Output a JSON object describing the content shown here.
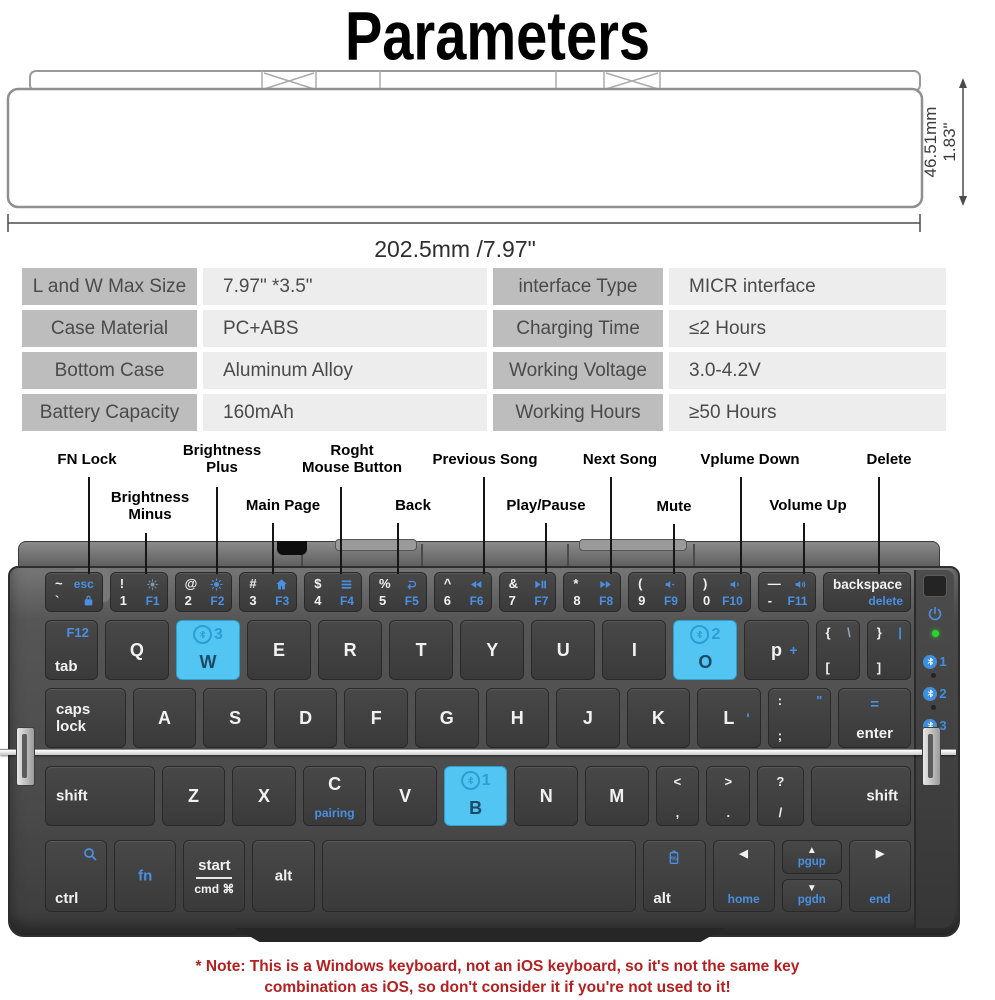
{
  "title": "Parameters",
  "colors": {
    "accent_blue": "#4a90e2",
    "highlight_cyan": "#52c5f2",
    "led_green": "#2ed32e",
    "note_red": "#b51f1f"
  },
  "dimensions": {
    "height_mm": "46.51mm",
    "height_in": "1.83\"",
    "width": "202.5mm /7.97\""
  },
  "spec_table": {
    "rows": [
      {
        "l_label": "L and W Max Size",
        "l_value": "7.97\"  *3.5\"",
        "r_label": "interface Type",
        "r_value": "MICR interface"
      },
      {
        "l_label": "Case Material",
        "l_value": "PC+ABS",
        "r_label": "Charging Time",
        "r_value": "≤2 Hours"
      },
      {
        "l_label": "Bottom Case",
        "l_value": "Aluminum Alloy",
        "r_label": "Working Voltage",
        "r_value": "3.0-4.2V"
      },
      {
        "l_label": "Battery Capacity",
        "l_value": "160mAh",
        "r_label": "Working Hours",
        "r_value": "≥50 Hours"
      }
    ]
  },
  "callouts": [
    {
      "id": "fn-lock",
      "label": "FN Lock"
    },
    {
      "id": "brightness-minus",
      "label": "Brightness\nMinus"
    },
    {
      "id": "brightness-plus",
      "label": "Brightness\nPlus"
    },
    {
      "id": "main-page",
      "label": "Main Page"
    },
    {
      "id": "roght-mouse-button",
      "label": "Roght\nMouse Button"
    },
    {
      "id": "back",
      "label": "Back"
    },
    {
      "id": "previous-song",
      "label": "Previous Song"
    },
    {
      "id": "play-pause",
      "label": "Play/Pause"
    },
    {
      "id": "next-song",
      "label": "Next Song"
    },
    {
      "id": "mute",
      "label": "Mute"
    },
    {
      "id": "vplume-down",
      "label": "Vplume Down"
    },
    {
      "id": "volume-up",
      "label": "Volume Up"
    },
    {
      "id": "delete",
      "label": "Delete"
    }
  ],
  "keyboard": {
    "rows": [
      [
        {
          "n": "key-grave-esc",
          "lg": [
            {
              "p": "tl",
              "t": "~"
            },
            {
              "p": "tr",
              "t": "esc",
              "c": "b",
              "s": "sm2"
            },
            {
              "p": "bl",
              "t": "`"
            },
            {
              "p": "br",
              "i": "lock-icon",
              "c": "b"
            }
          ]
        },
        {
          "n": "key-1-f1",
          "lg": [
            {
              "p": "tl",
              "t": "!"
            },
            {
              "p": "tr",
              "i": "sun-dim-icon",
              "c": "bg"
            },
            {
              "p": "bl",
              "t": "1"
            },
            {
              "p": "br",
              "t": "F1",
              "c": "b"
            }
          ]
        },
        {
          "n": "key-2-f2",
          "lg": [
            {
              "p": "tl",
              "t": "@"
            },
            {
              "p": "tr",
              "i": "sun-icon",
              "c": "b"
            },
            {
              "p": "bl",
              "t": "2"
            },
            {
              "p": "br",
              "t": "F2",
              "c": "b"
            }
          ]
        },
        {
          "n": "key-3-f3",
          "lg": [
            {
              "p": "tl",
              "t": "#"
            },
            {
              "p": "tr",
              "i": "home-icon",
              "c": "b"
            },
            {
              "p": "bl",
              "t": "3"
            },
            {
              "p": "br",
              "t": "F3",
              "c": "b"
            }
          ]
        },
        {
          "n": "key-4-f4",
          "lg": [
            {
              "p": "tl",
              "t": "$"
            },
            {
              "p": "tr",
              "i": "menu-icon",
              "c": "b"
            },
            {
              "p": "bl",
              "t": "4"
            },
            {
              "p": "br",
              "t": "F4",
              "c": "b"
            }
          ]
        },
        {
          "n": "key-5-f5",
          "lg": [
            {
              "p": "tl",
              "t": "%"
            },
            {
              "p": "tr",
              "i": "back-icon",
              "c": "b"
            },
            {
              "p": "bl",
              "t": "5"
            },
            {
              "p": "br",
              "t": "F5",
              "c": "b"
            }
          ]
        },
        {
          "n": "key-6-f6",
          "lg": [
            {
              "p": "tl",
              "t": "^"
            },
            {
              "p": "tr",
              "i": "prev-track-icon",
              "c": "b"
            },
            {
              "p": "bl",
              "t": "6"
            },
            {
              "p": "br",
              "t": "F6",
              "c": "b"
            }
          ]
        },
        {
          "n": "key-7-f7",
          "lg": [
            {
              "p": "tl",
              "t": "&"
            },
            {
              "p": "tr",
              "i": "play-pause-icon",
              "c": "b"
            },
            {
              "p": "bl",
              "t": "7"
            },
            {
              "p": "br",
              "t": "F7",
              "c": "b"
            }
          ]
        },
        {
          "n": "key-8-f8",
          "lg": [
            {
              "p": "tl",
              "t": "*"
            },
            {
              "p": "tr",
              "i": "next-track-icon",
              "c": "b"
            },
            {
              "p": "bl",
              "t": "8"
            },
            {
              "p": "br",
              "t": "F8",
              "c": "b"
            }
          ]
        },
        {
          "n": "key-9-f9",
          "lg": [
            {
              "p": "tl",
              "t": "("
            },
            {
              "p": "tr",
              "i": "mute-icon",
              "c": "b"
            },
            {
              "p": "bl",
              "t": "9"
            },
            {
              "p": "br",
              "t": "F9",
              "c": "b"
            }
          ]
        },
        {
          "n": "key-0-f10",
          "lg": [
            {
              "p": "tl",
              "t": ")"
            },
            {
              "p": "tr",
              "i": "vol-down-icon",
              "c": "b"
            },
            {
              "p": "bl",
              "t": "0"
            },
            {
              "p": "br",
              "t": "F10",
              "c": "b"
            }
          ]
        },
        {
          "n": "key-dash-f11",
          "lg": [
            {
              "p": "tl",
              "t": "—"
            },
            {
              "p": "tr",
              "i": "vol-up-icon",
              "c": "b"
            },
            {
              "p": "bl",
              "t": "-"
            },
            {
              "p": "br",
              "t": "F11",
              "c": "b"
            }
          ]
        },
        {
          "n": "key-backspace",
          "w": 1.55,
          "lg": [
            {
              "p": "tr",
              "t": "backspace",
              "s": "md"
            },
            {
              "p": "br",
              "t": "delete",
              "c": "b"
            }
          ]
        }
      ],
      [
        {
          "n": "key-tab",
          "w": 0.82,
          "lg": [
            {
              "p": "tr",
              "t": "F12",
              "c": "b"
            },
            {
              "p": "bl",
              "t": "tab",
              "s": "md2"
            }
          ]
        },
        {
          "n": "key-q",
          "lg": [
            {
              "p": "c",
              "t": "Q",
              "s": "lg"
            }
          ]
        },
        {
          "n": "key-w",
          "hl": 1,
          "bt": "3",
          "lg": [
            {
              "p": "cb",
              "t": "W",
              "s": "lg",
              "c": "d"
            }
          ]
        },
        {
          "n": "key-e",
          "lg": [
            {
              "p": "c",
              "t": "E",
              "s": "lg"
            }
          ]
        },
        {
          "n": "key-r",
          "lg": [
            {
              "p": "c",
              "t": "R",
              "s": "lg"
            }
          ]
        },
        {
          "n": "key-t",
          "lg": [
            {
              "p": "c",
              "t": "T",
              "s": "lg"
            }
          ]
        },
        {
          "n": "key-y",
          "lg": [
            {
              "p": "c",
              "t": "Y",
              "s": "lg"
            }
          ]
        },
        {
          "n": "key-u",
          "lg": [
            {
              "p": "c",
              "t": "U",
              "s": "lg"
            }
          ]
        },
        {
          "n": "key-i",
          "lg": [
            {
              "p": "c",
              "t": "I",
              "s": "lg"
            }
          ]
        },
        {
          "n": "key-o",
          "hl": 1,
          "bt": "2",
          "lg": [
            {
              "p": "cb",
              "t": "O",
              "s": "lg",
              "c": "d"
            }
          ]
        },
        {
          "n": "key-p",
          "lg": [
            {
              "p": "c",
              "t": "p",
              "s": "lg"
            },
            {
              "p": "cr",
              "t": "+",
              "c": "b"
            }
          ]
        },
        {
          "n": "key-lbracket",
          "w": 0.68,
          "lg": [
            {
              "p": "tl",
              "t": "{"
            },
            {
              "p": "tr",
              "t": "\\",
              "c": "bg"
            },
            {
              "p": "bl",
              "t": "["
            }
          ]
        },
        {
          "n": "key-rbracket",
          "w": 0.68,
          "lg": [
            {
              "p": "tl",
              "t": "}"
            },
            {
              "p": "tr",
              "t": "|",
              "c": "b"
            },
            {
              "p": "bl",
              "t": "]"
            }
          ]
        }
      ],
      [
        {
          "n": "key-caps-lock",
          "w": 1.28,
          "lg": [
            {
              "p": "cl",
              "t": "caps\nlock"
            }
          ]
        },
        {
          "n": "key-a",
          "lg": [
            {
              "p": "c",
              "t": "A",
              "s": "lg"
            }
          ]
        },
        {
          "n": "key-s",
          "lg": [
            {
              "p": "c",
              "t": "S",
              "s": "lg"
            }
          ]
        },
        {
          "n": "key-d",
          "lg": [
            {
              "p": "c",
              "t": "D",
              "s": "lg"
            }
          ]
        },
        {
          "n": "key-f",
          "lg": [
            {
              "p": "c",
              "t": "F",
              "s": "lg"
            }
          ]
        },
        {
          "n": "key-g",
          "lg": [
            {
              "p": "c",
              "t": "G",
              "s": "lg"
            }
          ]
        },
        {
          "n": "key-h",
          "lg": [
            {
              "p": "c",
              "t": "H",
              "s": "lg"
            }
          ]
        },
        {
          "n": "key-j",
          "lg": [
            {
              "p": "c",
              "t": "J",
              "s": "lg"
            }
          ]
        },
        {
          "n": "key-k",
          "lg": [
            {
              "p": "c",
              "t": "K",
              "s": "lg"
            }
          ]
        },
        {
          "n": "key-l",
          "lg": [
            {
              "p": "c",
              "t": "L",
              "s": "lg"
            },
            {
              "p": "cr",
              "t": "'",
              "c": "b"
            }
          ]
        },
        {
          "n": "key-semicolon",
          "lg": [
            {
              "p": "tl",
              "t": ":"
            },
            {
              "p": "tr",
              "t": "\"",
              "c": "b"
            },
            {
              "p": "bl",
              "t": ";"
            }
          ]
        },
        {
          "n": "key-enter",
          "w": 1.15,
          "lg": [
            {
              "p": "tc",
              "t": "=",
              "c": "b",
              "s": "md2"
            },
            {
              "p": "bc",
              "t": "enter",
              "s": "md2"
            }
          ]
        }
      ],
      [
        {
          "n": "key-shift-left",
          "w": 1.75,
          "lg": [
            {
              "p": "cl",
              "t": "shift"
            }
          ]
        },
        {
          "n": "key-z",
          "lg": [
            {
              "p": "c",
              "t": "Z",
              "s": "lg"
            }
          ]
        },
        {
          "n": "key-x",
          "lg": [
            {
              "p": "c",
              "t": "X",
              "s": "lg"
            }
          ]
        },
        {
          "n": "key-c",
          "lg": [
            {
              "p": "tc",
              "t": "C",
              "s": "lg"
            },
            {
              "p": "bc",
              "t": "pairing",
              "c": "b",
              "s": "sm2"
            }
          ]
        },
        {
          "n": "key-v",
          "lg": [
            {
              "p": "c",
              "t": "V",
              "s": "lg"
            }
          ]
        },
        {
          "n": "key-b",
          "hl": 1,
          "bt": "1",
          "lg": [
            {
              "p": "cb",
              "t": "B",
              "s": "lg",
              "c": "d"
            }
          ]
        },
        {
          "n": "key-n",
          "lg": [
            {
              "p": "c",
              "t": "N",
              "s": "lg"
            }
          ]
        },
        {
          "n": "key-m",
          "lg": [
            {
              "p": "c",
              "t": "M",
              "s": "lg"
            }
          ]
        },
        {
          "n": "key-comma",
          "w": 0.68,
          "lg": [
            {
              "p": "tc",
              "t": "<"
            },
            {
              "p": "bc",
              "t": ","
            }
          ]
        },
        {
          "n": "key-period",
          "w": 0.68,
          "lg": [
            {
              "p": "tc",
              "t": ">"
            },
            {
              "p": "bc",
              "t": "."
            }
          ]
        },
        {
          "n": "key-slash",
          "w": 0.72,
          "lg": [
            {
              "p": "tc",
              "t": "?"
            },
            {
              "p": "bc",
              "t": "/"
            }
          ]
        },
        {
          "n": "key-shift-right",
          "w": 1.6,
          "lg": [
            {
              "p": "cr2",
              "t": "shift"
            }
          ]
        }
      ],
      [
        {
          "n": "key-ctrl",
          "lg": [
            {
              "p": "tr",
              "i": "search-icon",
              "c": "b"
            },
            {
              "p": "bl",
              "t": "ctrl",
              "s": "md2"
            }
          ]
        },
        {
          "n": "key-fn",
          "lg": [
            {
              "p": "c",
              "t": "fn",
              "c": "b",
              "s": "md2"
            }
          ]
        },
        {
          "n": "key-start-cmd",
          "start": {
            "top": "start",
            "bottom": "cmd ⌘"
          }
        },
        {
          "n": "key-alt-left",
          "lg": [
            {
              "p": "c",
              "t": "alt",
              "s": "md2"
            }
          ]
        },
        {
          "n": "key-space",
          "w": 5.2,
          "lg": []
        },
        {
          "n": "key-alt-right",
          "lg": [
            {
              "p": "tc",
              "i": "battery-icon",
              "c": "b"
            },
            {
              "p": "bl",
              "t": "alt",
              "s": "md2"
            }
          ]
        },
        {
          "n": "key-home",
          "lg": [
            {
              "p": "tc",
              "t": "◀",
              "s": "sm"
            },
            {
              "p": "bc",
              "t": "home",
              "c": "b",
              "s": "sm2"
            }
          ]
        },
        {
          "n": "key-pgup-pgdn",
          "stack": [
            {
              "arrow": "▲",
              "t": "pgup"
            },
            {
              "arrow": "▼",
              "t": "pgdn"
            }
          ]
        },
        {
          "n": "key-end",
          "lg": [
            {
              "p": "tc",
              "t": "▶",
              "s": "sm"
            },
            {
              "p": "bc",
              "t": "end",
              "c": "b",
              "s": "sm2"
            }
          ]
        }
      ]
    ],
    "sidebar": {
      "bt_indicators": [
        "1",
        "2",
        "3"
      ]
    }
  },
  "note_line1": "* Note: This is a Windows keyboard, not an iOS keyboard, so it's not the same key",
  "note_line2": "combination as iOS, so don't consider it if you're not used to it!"
}
